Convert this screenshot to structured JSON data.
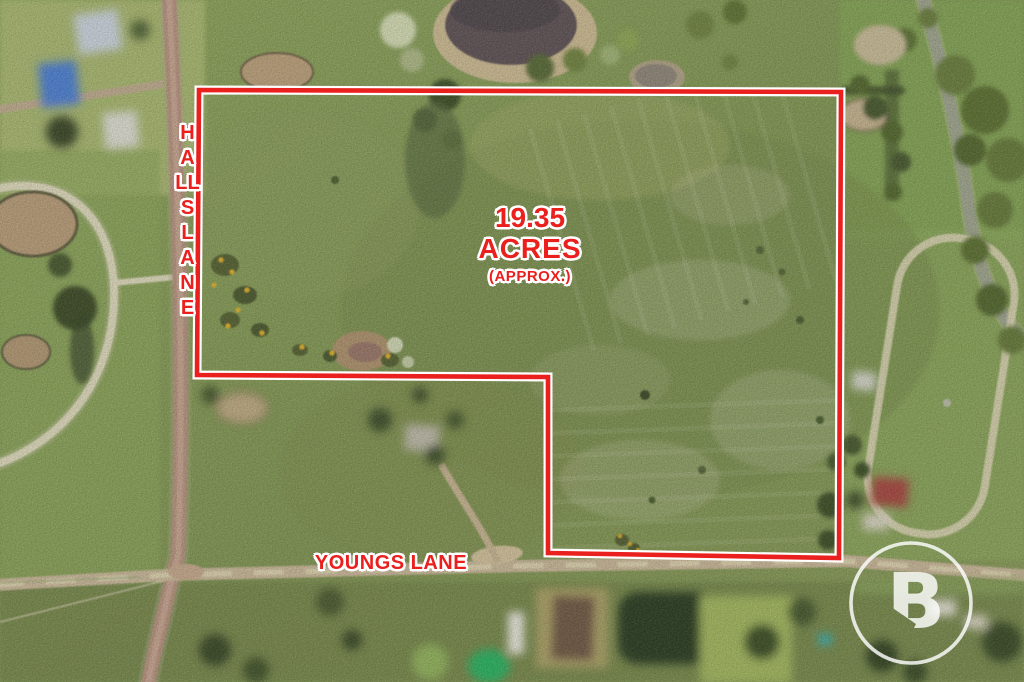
{
  "annotation": {
    "area_value": "19.35",
    "area_unit": "ACRES",
    "area_qualifier": "(APPROX.)",
    "road_label_left": "HALLS LANE",
    "road_label_bottom": "YOUNGS LANE",
    "red": "#e9201d",
    "outline_white": "#ffffff"
  },
  "boundary": {
    "points": "199,90 841,92 839,558 548,553 548,377 197,375"
  },
  "logo": {
    "letter": "B",
    "color": "#ffffff"
  }
}
